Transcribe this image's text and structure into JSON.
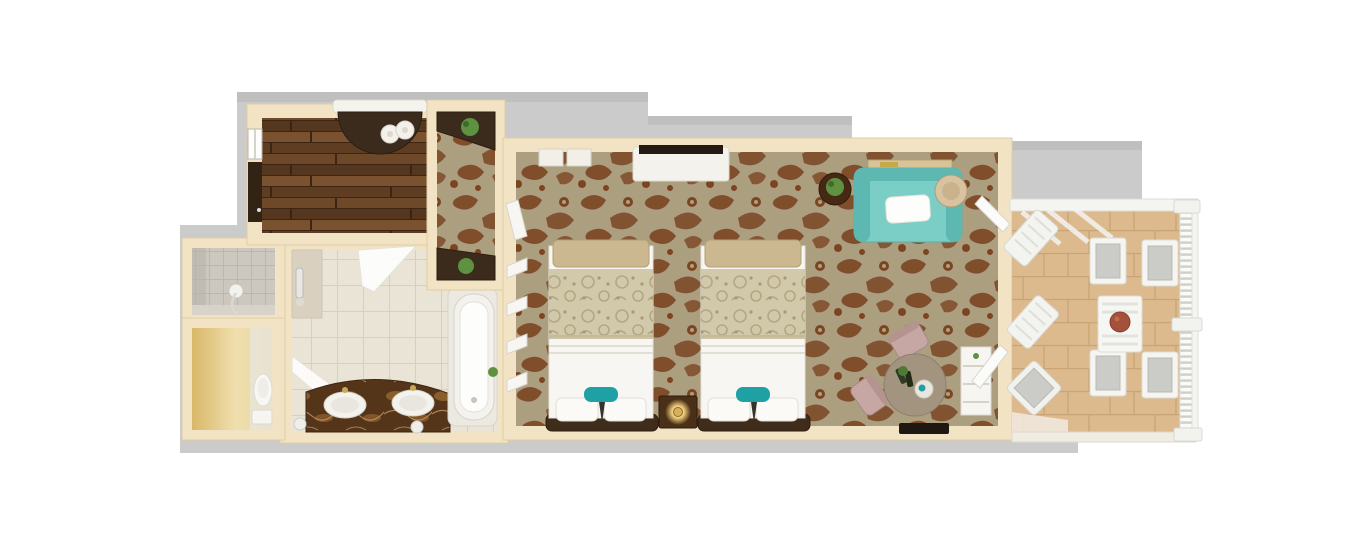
{
  "canvas": {
    "width": 1370,
    "height": 550,
    "background": "#ffffff"
  },
  "view": "top-down 3D rendered floor plan of a hotel suite, no visible text",
  "colors": {
    "backdrop": "#cbcbcb",
    "backdrop_shade": "#bfbfbf",
    "wall": "#f2e3c5",
    "wall_edge": "#dfcba1",
    "wood_floor": "#7a5230",
    "carpet_base": "#ab9f80",
    "carpet_motif": "#7c4522",
    "paisley": "#d2c8aa",
    "bath_tile": "#eae4d6",
    "bath_tile_line": "#d6cfbf",
    "shower_tile": "#cdc8bf",
    "wc_floor_bright": "#f0dfae",
    "wc_floor_deep": "#d8b768",
    "balcony_tile": "#dcba8d",
    "balcony_tile_line": "#c8a477",
    "railing_white": "#f4f4f1",
    "sofa_teal": "#7bcec6",
    "sofa_teal_dark": "#5cb8b0",
    "accent_teal": "#1fa0a5",
    "bed_white": "#f7f6f2",
    "bench_tan": "#cbb890",
    "bed_frame": "#3f2c1a",
    "nightstand": "#4a3018",
    "wood_dark": "#3b2b1d",
    "vanity_marble": "#55351a",
    "marble_vein": "#9c6a33",
    "tub_white": "#f3f2ee",
    "plant_green": "#5e9140",
    "table_taupe": "#a3947f",
    "chair_mauve": "#c7a7a3",
    "cushion_gray": "#cbcbc7",
    "fruit_bowl": "#a3513b",
    "lamp_glow": "#f3cf7e",
    "tv_dark": "#241a12"
  },
  "rooms": [
    {
      "id": "dressing-room",
      "floor": "dark hardwood planks"
    },
    {
      "id": "entry-hall",
      "floor": "patterned carpet"
    },
    {
      "id": "shower-room",
      "floor": "gray tile walk-in shower"
    },
    {
      "id": "water-closet",
      "floor": "warm lit stone"
    },
    {
      "id": "bathroom",
      "floor": "cream tile"
    },
    {
      "id": "bedroom",
      "floor": "brown damask carpet"
    },
    {
      "id": "balcony",
      "floor": "tan tile"
    }
  ],
  "furniture": {
    "dressing_room": [
      "curved dark console with rolled towels",
      "window",
      "dark closet door panel"
    ],
    "entry_hall": [
      "corner shelf with plant (top)",
      "corner shelf with plant (bottom)"
    ],
    "shower_room": [
      "wall shower valve with hose"
    ],
    "water_closet": [
      "toilet"
    ],
    "bathroom": [
      "marble double-sink vanity",
      "bathtub with deck",
      "angled glass shower panels",
      "shower niche"
    ],
    "bedroom": [
      "queen bed 1",
      "queen bed 2",
      "nightstand with lit lamp",
      "teal loveseat with white pillow",
      "round side table with plant",
      "round rattan chair",
      "round table with wine service",
      "two mauve chairs",
      "white shelving console",
      "tv console",
      "louvered closet doors",
      "entry door leaf",
      "two french doors to balcony"
    ],
    "balcony": [
      "slatted outdoor table with fruit bowl",
      "four cushioned armchairs",
      "two angled door/lounger panels",
      "angled cushioned corner chair",
      "baluster railing",
      "pergola beams"
    ]
  }
}
